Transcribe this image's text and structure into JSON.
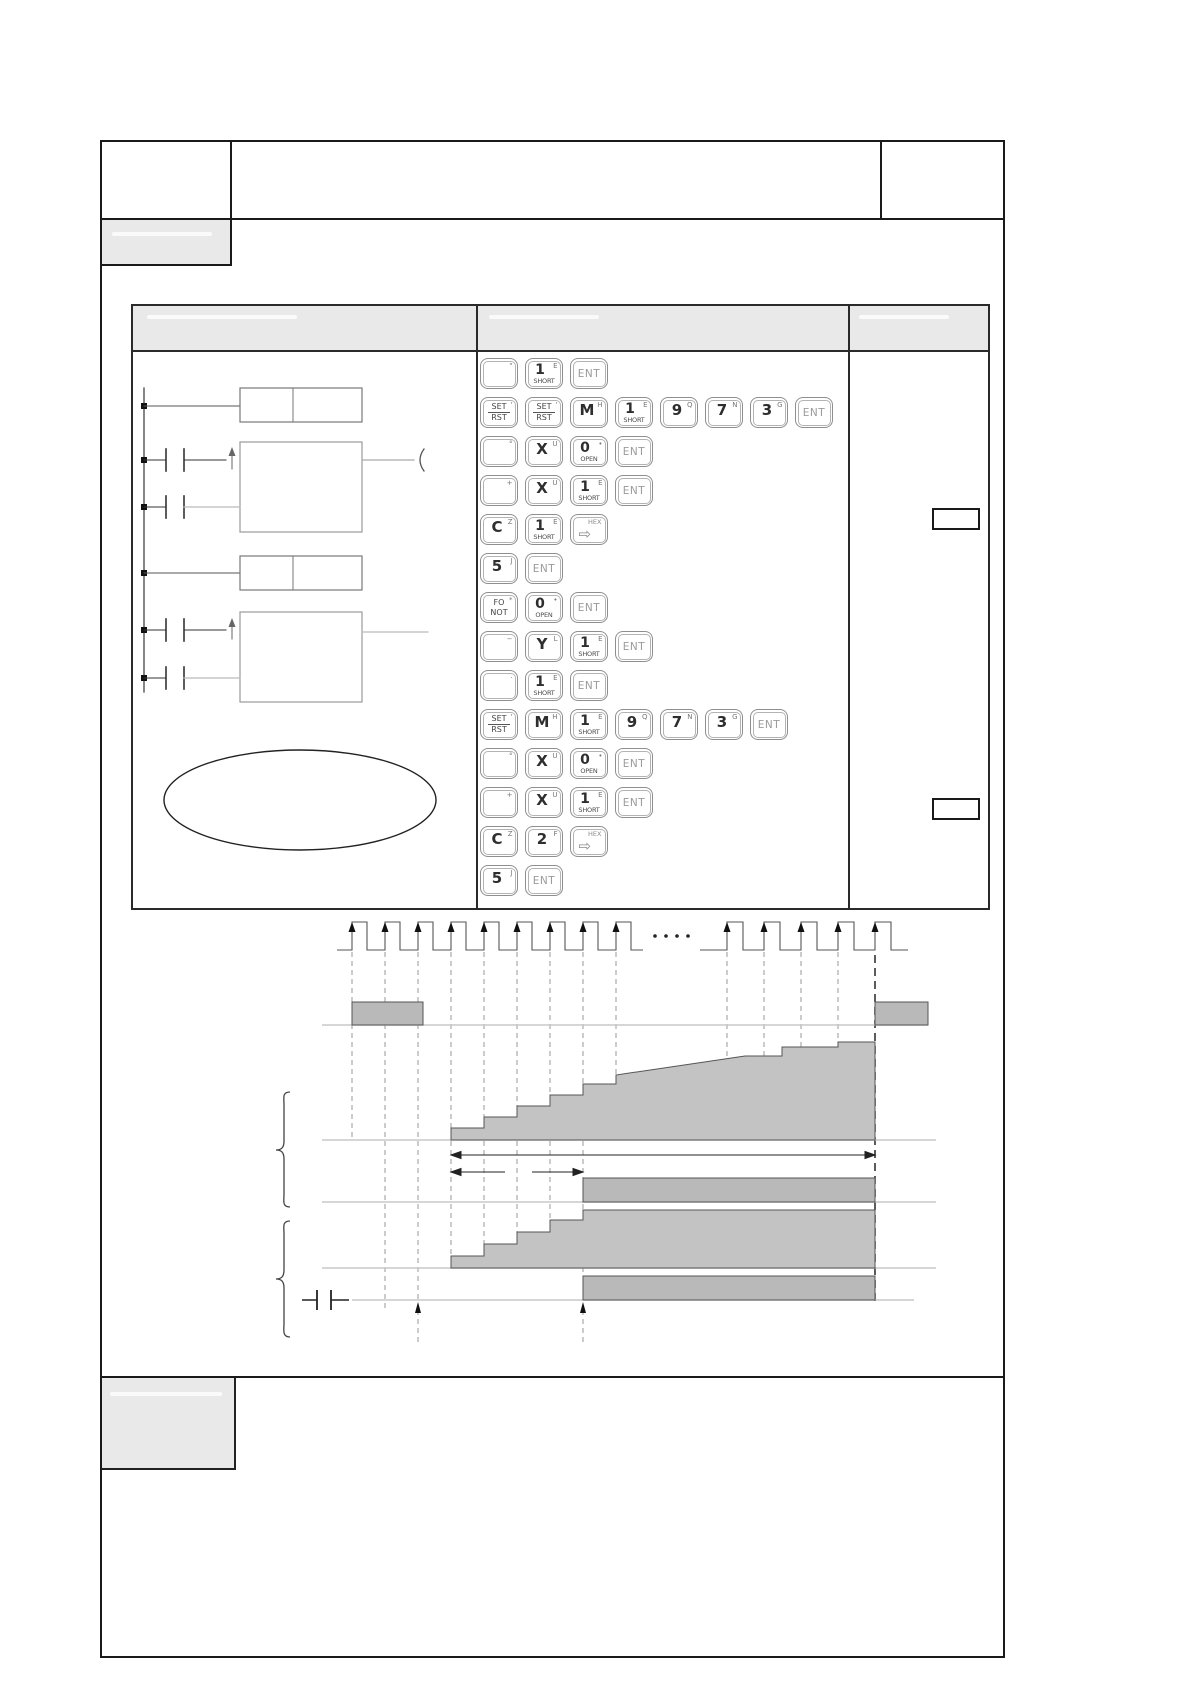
{
  "document": {
    "kind": "plc-programming-manual-page",
    "visible_text": "only programmer key-cap legends are legible; all other fields are blank/whited-out"
  },
  "colors": {
    "page_bg": "#ffffff",
    "frame_border": "#1a1a1a",
    "header_fill": "#e9e9e9",
    "key_border": "#8f8f8f",
    "key_text": "#2e2e2e",
    "ent_text": "#9b9b9b",
    "bar_fill": "#b9b9b9",
    "stair_fill": "#c3c3c3",
    "baseline_gray": "#c8c8c8",
    "ladder_stroke": "#666666"
  },
  "keypad": {
    "rows": [
      [
        {
          "type": "blank",
          "sup": "\""
        },
        {
          "type": "stack",
          "main": "1",
          "sup": "E",
          "sub": "SHORT"
        },
        {
          "type": "ent",
          "label": "ENT"
        }
      ],
      [
        {
          "type": "frac",
          "top": "SET",
          "bottom": "RST",
          "sup": "'"
        },
        {
          "type": "frac",
          "top": "SET",
          "bottom": "RST",
          "sup": "'"
        },
        {
          "type": "plain",
          "main": "M",
          "sup": "H"
        },
        {
          "type": "stack",
          "main": "1",
          "sup": "E",
          "sub": "SHORT"
        },
        {
          "type": "plain",
          "main": "9",
          "sup": "Q"
        },
        {
          "type": "plain",
          "main": "7",
          "sup": "N"
        },
        {
          "type": "plain",
          "main": "3",
          "sup": "G"
        },
        {
          "type": "ent",
          "label": "ENT"
        }
      ],
      [
        {
          "type": "blank",
          "sup": "°"
        },
        {
          "type": "plain",
          "main": "X",
          "sup": "U"
        },
        {
          "type": "stack",
          "main": "0",
          "sup": "•",
          "sub": "OPEN"
        },
        {
          "type": "ent",
          "label": "ENT"
        }
      ],
      [
        {
          "type": "blank",
          "sup": "+"
        },
        {
          "type": "plain",
          "main": "X",
          "sup": "U"
        },
        {
          "type": "stack",
          "main": "1",
          "sup": "E",
          "sub": "SHORT"
        },
        {
          "type": "ent",
          "label": "ENT"
        }
      ],
      [
        {
          "type": "plain",
          "main": "C",
          "sup": "Z"
        },
        {
          "type": "stack",
          "main": "1",
          "sup": "E",
          "sub": "SHORT"
        },
        {
          "type": "hex",
          "top": "HEX",
          "arrow": "⇨"
        }
      ],
      [
        {
          "type": "plain",
          "main": "5",
          "sup": "J"
        },
        {
          "type": "ent",
          "label": "ENT"
        }
      ],
      [
        {
          "type": "twoline",
          "top": "FO",
          "bottom": "NOT",
          "sup": "*"
        },
        {
          "type": "stack",
          "main": "0",
          "sup": "•",
          "sub": "OPEN"
        },
        {
          "type": "ent",
          "label": "ENT"
        }
      ],
      [
        {
          "type": "blank",
          "sup": "−"
        },
        {
          "type": "plain",
          "main": "Y",
          "sup": "L"
        },
        {
          "type": "stack",
          "main": "1",
          "sup": "E",
          "sub": "SHORT"
        },
        {
          "type": "ent",
          "label": "ENT"
        }
      ],
      [
        {
          "type": "blank",
          "sup": "·"
        },
        {
          "type": "stack",
          "main": "1",
          "sup": "E",
          "sub": "SHORT"
        },
        {
          "type": "ent",
          "label": "ENT"
        }
      ],
      [
        {
          "type": "frac",
          "top": "SET",
          "bottom": "RST",
          "sup": "'"
        },
        {
          "type": "plain",
          "main": "M",
          "sup": "H"
        },
        {
          "type": "stack",
          "main": "1",
          "sup": "E",
          "sub": "SHORT"
        },
        {
          "type": "plain",
          "main": "9",
          "sup": "Q"
        },
        {
          "type": "plain",
          "main": "7",
          "sup": "N"
        },
        {
          "type": "plain",
          "main": "3",
          "sup": "G"
        },
        {
          "type": "ent",
          "label": "ENT"
        }
      ],
      [
        {
          "type": "blank",
          "sup": "°"
        },
        {
          "type": "plain",
          "main": "X",
          "sup": "U"
        },
        {
          "type": "stack",
          "main": "0",
          "sup": "•",
          "sub": "OPEN"
        },
        {
          "type": "ent",
          "label": "ENT"
        }
      ],
      [
        {
          "type": "blank",
          "sup": "+"
        },
        {
          "type": "plain",
          "main": "X",
          "sup": "U"
        },
        {
          "type": "stack",
          "main": "1",
          "sup": "E",
          "sub": "SHORT"
        },
        {
          "type": "ent",
          "label": "ENT"
        }
      ],
      [
        {
          "type": "plain",
          "main": "C",
          "sup": "Z"
        },
        {
          "type": "plain",
          "main": "2",
          "sup": "F"
        },
        {
          "type": "hex",
          "top": "HEX",
          "arrow": "⇨"
        }
      ],
      [
        {
          "type": "plain",
          "main": "5",
          "sup": "J"
        },
        {
          "type": "ent",
          "label": "ENT"
        }
      ]
    ]
  },
  "right_column": {
    "comment_box_count": 2
  },
  "ladder": {
    "rungs": 6,
    "contacts": 4,
    "rising_edge_arrows": 2,
    "instruction_cells": 2,
    "function_blocks": 2,
    "ellipse_callout": 1
  },
  "timing_diagram": {
    "clock_pulses_before_break": 9,
    "break_dots": 4,
    "clock_pulses_after_break": 5,
    "signal_bars": 4,
    "staircases": 2,
    "dimension_arrows": 2,
    "braces": 2,
    "bottom_edge_markers": 2
  }
}
